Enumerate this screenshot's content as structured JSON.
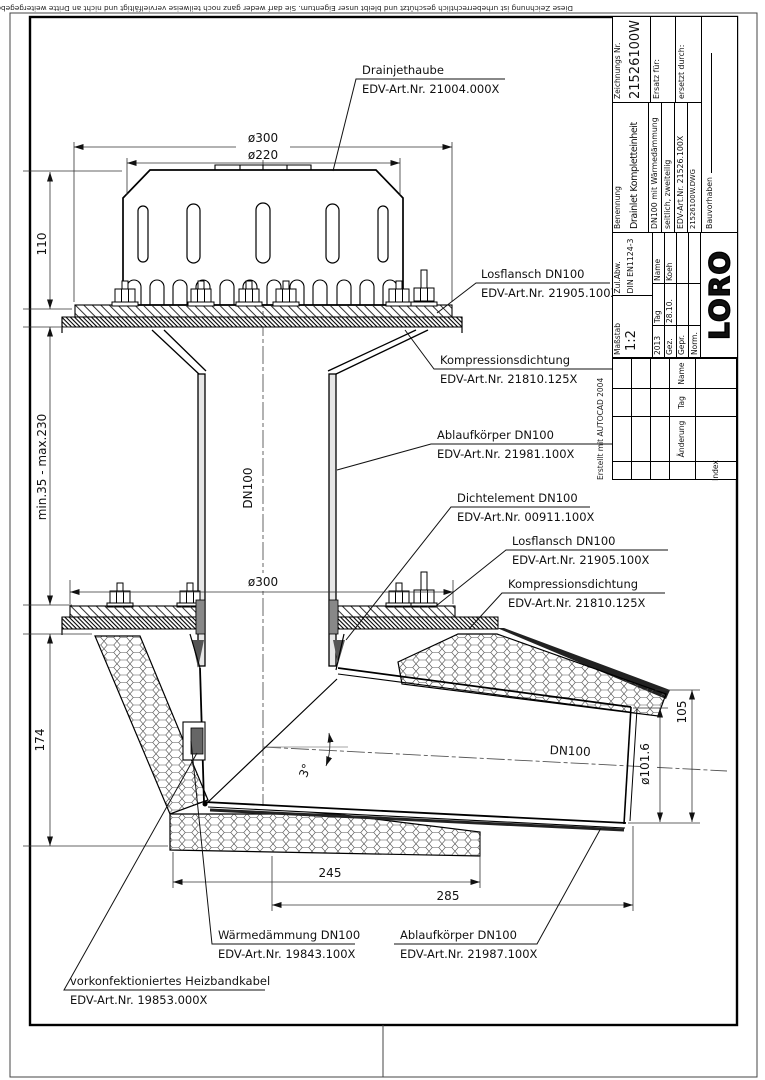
{
  "sheet": {
    "copyright_notice": "Diese Zeichnung ist urheberrechtlich geschützt und bleibt unser Eigentum. Sie darf weder ganz noch teilweise vervielfältigt und nicht an Dritte weitergegeben werden.",
    "autocad_note": "Erstellt mit AUTOCAD 2004"
  },
  "title_block": {
    "masstab_label": "Maßstab",
    "masstab_value": "1:2",
    "zulabw_label": "Zul.Abw.",
    "zulabw_value": "DIN EN1124-3",
    "approval": {
      "year": "2013",
      "tag_label": "Tag",
      "name_label": "Name",
      "rows": [
        {
          "role": "Gez.",
          "date": "28.10.",
          "name": "Koeh"
        },
        {
          "role": "Gepr.",
          "date": "",
          "name": ""
        },
        {
          "role": "Norm.",
          "date": "",
          "name": ""
        }
      ]
    },
    "logo_text": "LORO",
    "benennung_label": "Benennung",
    "benennung_value": "Drainlet Kompletteinheit",
    "description_lines": [
      "DN100 mit Wärmedämmung",
      "seitlich, zweiteilig",
      "EDV-Art.Nr. 21526.100X"
    ],
    "dwg_file": "21526100W.DWG",
    "bauvorhaben_label": "Bauvorhaben",
    "zeichnung_label": "Zeichnungs Nr.",
    "zeichnung_value": "21526100W",
    "ersatz_label": "Ersatz für:",
    "ersetzt_label": "ersetzt durch:",
    "revision": {
      "aenderung_label": "Änderung",
      "tag_label": "Tag",
      "name_label": "Name",
      "index_label": "Index"
    }
  },
  "labels": {
    "drainjethaube": {
      "line1": "Drainjethaube",
      "line2": "EDV-Art.Nr. 21004.000X"
    },
    "losflansch_top": {
      "line1": "Losflansch DN100",
      "line2": "EDV-Art.Nr. 21905.100X"
    },
    "kompression_top": {
      "line1": "Kompressionsdichtung",
      "line2": "EDV-Art.Nr. 21810.125X"
    },
    "ablaufkoerper_top": {
      "line1": "Ablaufkörper DN100",
      "line2": "EDV-Art.Nr. 21981.100X"
    },
    "dichtelement": {
      "line1": "Dichtelement DN100",
      "line2": "EDV-Art.Nr. 00911.100X"
    },
    "losflansch_bottom": {
      "line1": "Losflansch DN100",
      "line2": "EDV-Art.Nr. 21905.100X"
    },
    "kompression_bottom": {
      "line1": "Kompressionsdichtung",
      "line2": "EDV-Art.Nr. 21810.125X"
    },
    "waermedaemmung": {
      "line1": "Wärmedämmung DN100",
      "line2": "EDV-Art.Nr. 19843.100X"
    },
    "ablaufkoerper_bottom": {
      "line1": "Ablaufkörper DN100",
      "line2": "EDV-Art.Nr. 21987.100X"
    },
    "heizbandkabel": {
      "line1": "vorkonfektioniertes Heizbandkabel",
      "line2": "EDV-Art.Nr. 19853.000X"
    }
  },
  "dims": {
    "dia300_top": "ø300",
    "dia220": "ø220",
    "height110": "110",
    "min_max": "min.35 - max.230",
    "height174": "174",
    "dia300_bottom": "ø300",
    "width245": "245",
    "width285": "285",
    "height105": "105",
    "dia101_6": "ø101.6",
    "dn100_riser": "DN100",
    "dn100_outlet": "DN100",
    "angle3": "3°"
  },
  "colors": {
    "line": "#111",
    "hatch": "#333",
    "insulation": "#555"
  }
}
